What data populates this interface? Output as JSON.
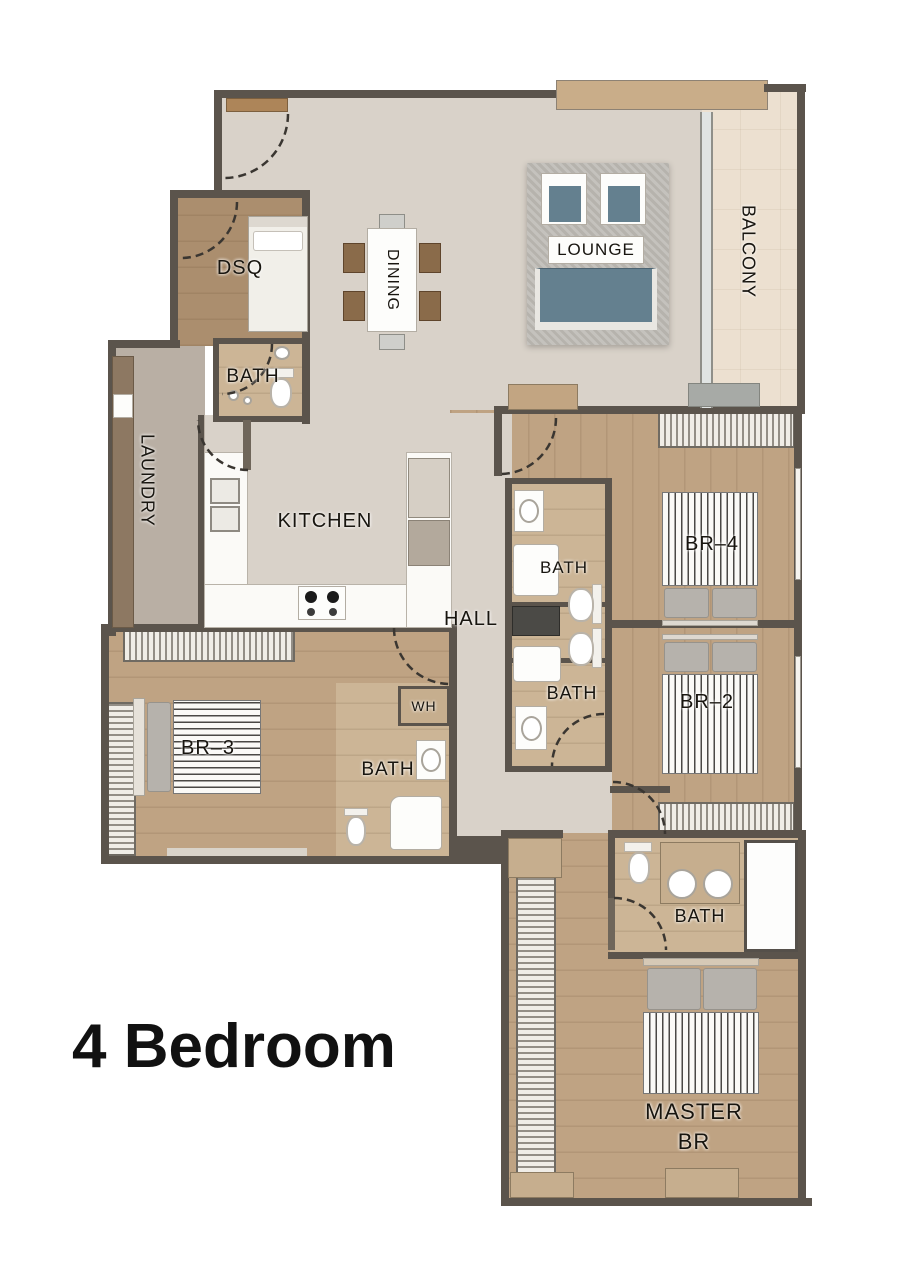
{
  "title": "4 Bedroom",
  "rooms": {
    "lounge": "LOUNGE",
    "dining": "DINING",
    "balcony": "BALCONY",
    "dsq": "DSQ",
    "bath": "BATH",
    "laundry": "LAUNDRY",
    "kitchen": "KITCHEN",
    "hall": "HALL",
    "wh": "WH",
    "br4": "BR–4",
    "br2": "BR–2",
    "br3": "BR–3",
    "master_line1": "MASTER",
    "master_line2": "BR"
  },
  "colors": {
    "background": "#ffffff",
    "wall": "#5b544c",
    "floor_living": "#d9d2c9",
    "floor_wood": "#bfa383",
    "floor_bath": "#ccb596",
    "balcony_tile": "#ece0d0",
    "laundry_floor": "#b9afa4",
    "rug": "#b6b3ad",
    "upholstery": "#64808f",
    "counter": "#fbfaf7",
    "wood_furniture": "#8a6b4a",
    "label_text": "#18150f",
    "title_text": "#111111"
  }
}
